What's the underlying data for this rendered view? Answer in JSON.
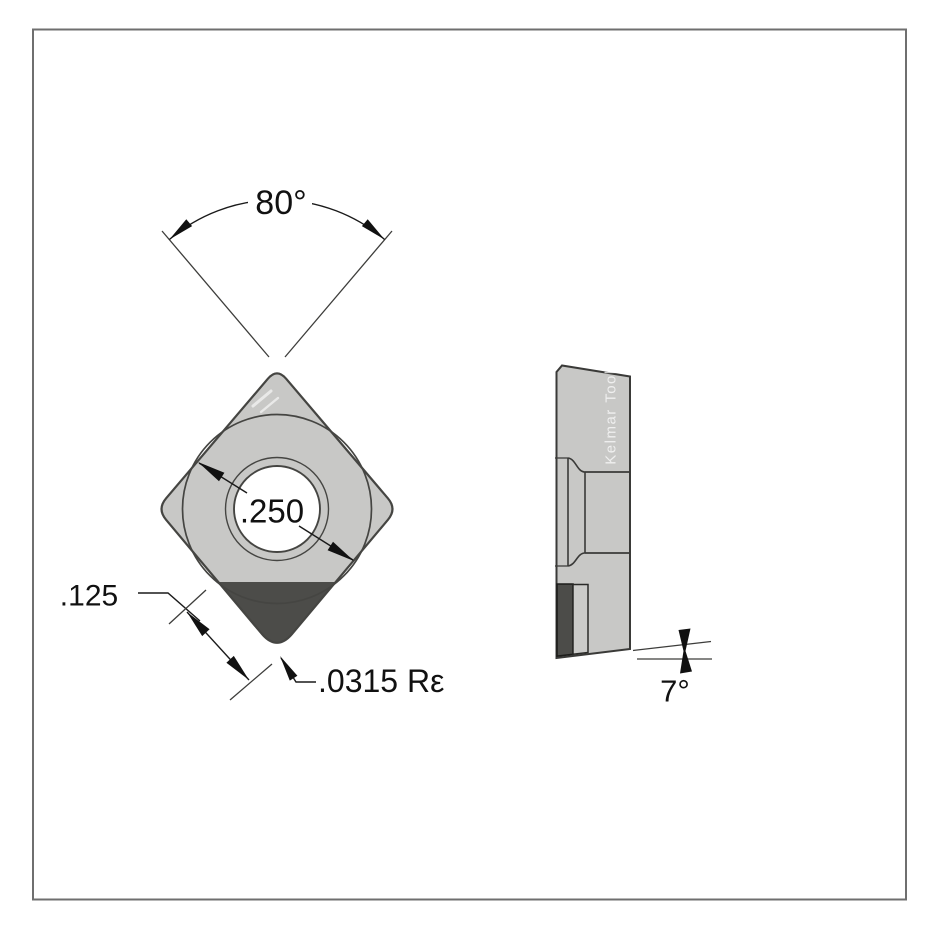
{
  "drawing": {
    "front_view": {
      "angle_label": "80°",
      "inscribed_circle_label": ".250",
      "tip_length_label": ".125",
      "corner_radius_label": ".0315 Rε"
    },
    "side_view": {
      "brand_label": "Kelmar Tool",
      "clearance_angle_label": "7°"
    },
    "colors": {
      "background": "#ffffff",
      "border": "#6f6f6f",
      "insert_body_gray": "#c8c8c6",
      "tip_dark_gray": "#4c4c49",
      "shim_gray": "#cbcbc9",
      "outline_dark": "#454542",
      "dimension_black": "#111111",
      "hole_white": "#ffffff"
    }
  }
}
